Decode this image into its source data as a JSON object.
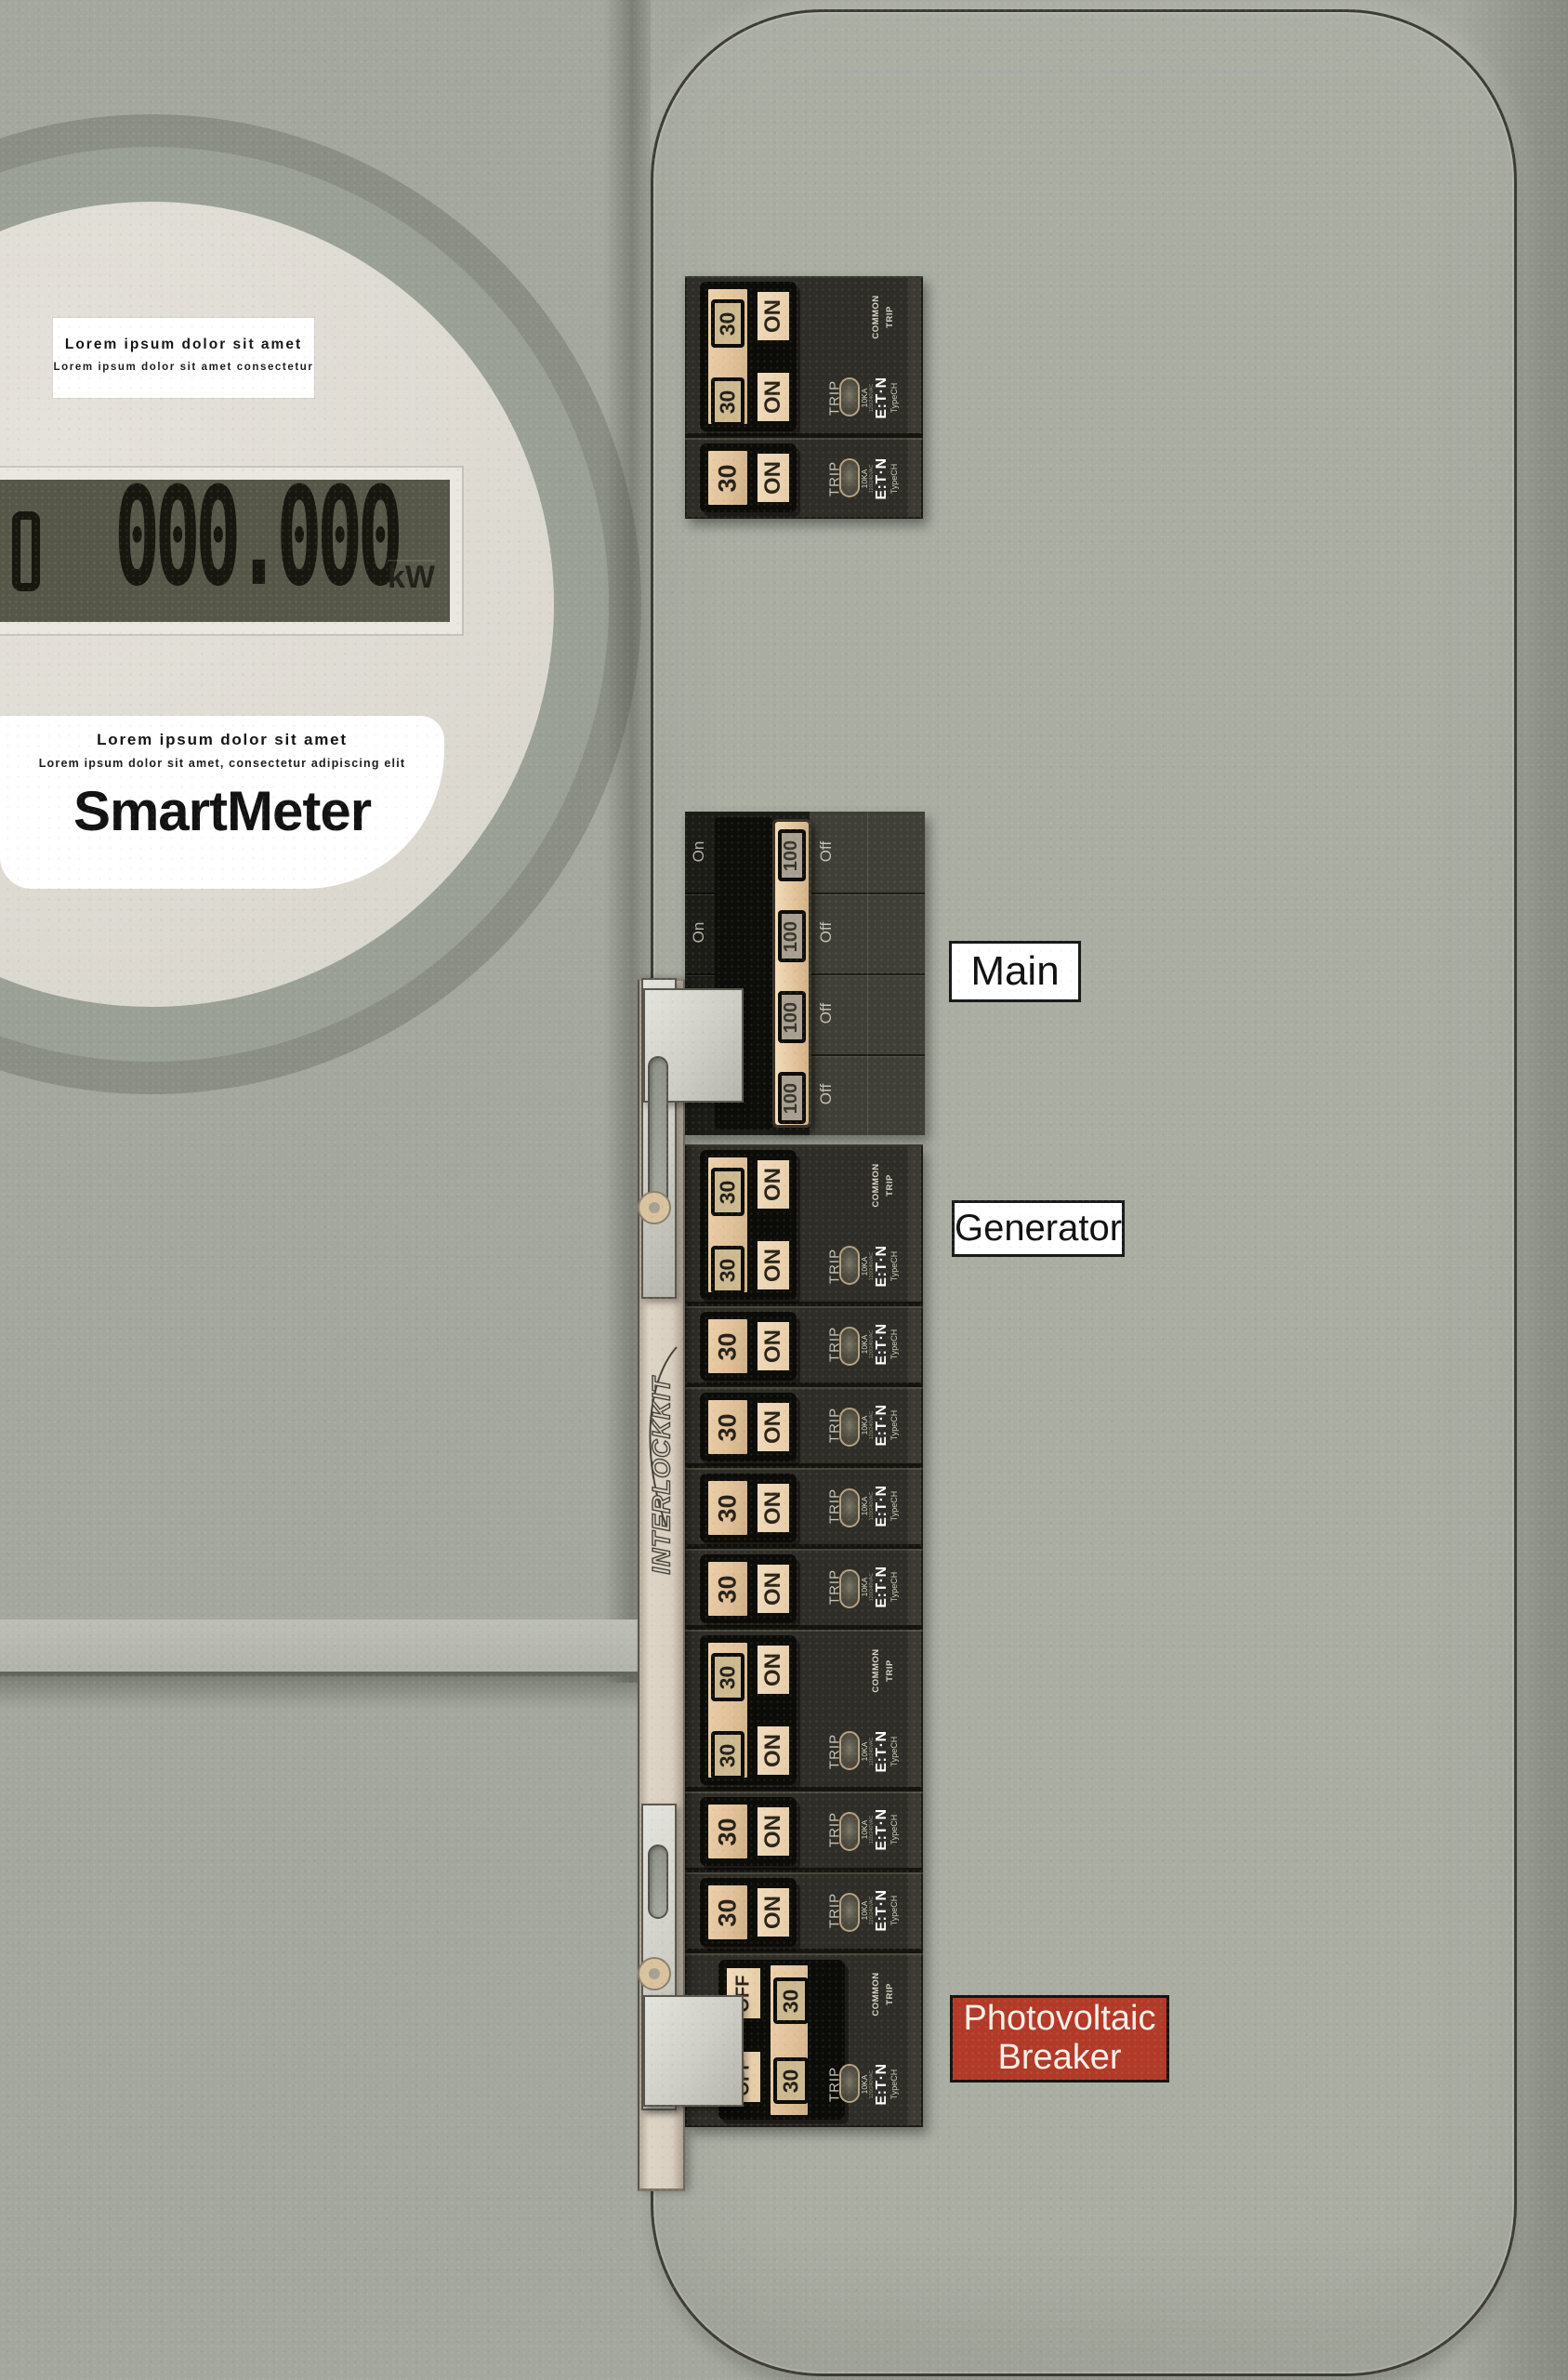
{
  "meter": {
    "label_top": {
      "line1": "Lorem ipsum dolor sit amet",
      "line2": "Lorem ipsum dolor sit amet consectetur"
    },
    "lcd": {
      "value": "000.000",
      "unit": "kW"
    },
    "label_bottom": {
      "line1": "Lorem ipsum dolor sit amet",
      "line2": "Lorem ipsum dolor sit amet, consectetur adipiscing elit",
      "brand": "SmartMeter"
    }
  },
  "panel": {
    "tags": {
      "main": "Main",
      "generator": "Generator",
      "pv_line1": "Photovoltaic",
      "pv_line2": "Breaker"
    },
    "interlock": {
      "brand": "INTERLOCKKIT"
    },
    "breaker": {
      "on": "ON",
      "off": "OFF",
      "amp30": "30",
      "amp100": "100",
      "trip": "TRIP",
      "rating": "10KA",
      "voltage": "120/240VAC",
      "maker": "E:T·N",
      "type": "TypeCH",
      "common_line1": "COMMON",
      "common_line2": "TRIP",
      "main_on": "On",
      "main_off": "Off"
    }
  },
  "colors": {
    "pv_tag_bg": "#b23a28",
    "handle_tan": "#e3c49c",
    "panel_face": "#a9ada2",
    "chassis_dark": "#2e2d27",
    "lcd_bg": "#565749",
    "meter_face": "#dfdcd4"
  }
}
